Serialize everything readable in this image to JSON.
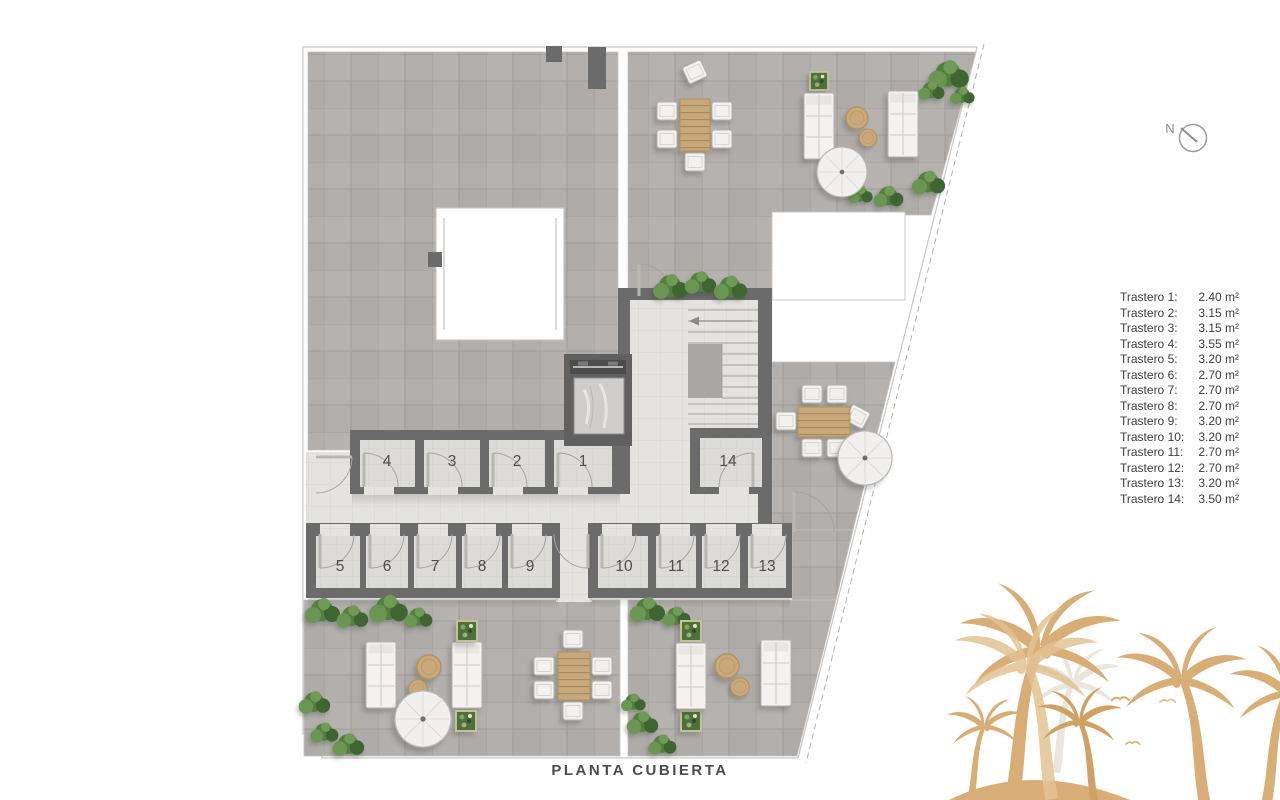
{
  "title": {
    "text": "PLANTA CUBIERTA"
  },
  "compass": {
    "label": "N"
  },
  "legend": {
    "items": [
      {
        "name": "Trastero 1:",
        "area": "2.40 m²"
      },
      {
        "name": "Trastero 2:",
        "area": "3.15 m²"
      },
      {
        "name": "Trastero 3:",
        "area": "3.15 m²"
      },
      {
        "name": "Trastero 4:",
        "area": "3.55 m²"
      },
      {
        "name": "Trastero 5:",
        "area": "3.20 m²"
      },
      {
        "name": "Trastero 6:",
        "area": "2.70 m²"
      },
      {
        "name": "Trastero 7:",
        "area": "2.70 m²"
      },
      {
        "name": "Trastero 8:",
        "area": "2.70 m²"
      },
      {
        "name": "Trastero 9:",
        "area": "3.20 m²"
      },
      {
        "name": "Trastero 10:",
        "area": "3.20 m²"
      },
      {
        "name": "Trastero 11:",
        "area": "2.70 m²"
      },
      {
        "name": "Trastero 12:",
        "area": "2.70 m²"
      },
      {
        "name": "Trastero 13:",
        "area": "3.20 m²"
      },
      {
        "name": "Trastero 14:",
        "area": "3.50 m²"
      }
    ]
  },
  "plan": {
    "rooms": {
      "r1": {
        "number": "1"
      },
      "r2": {
        "number": "2"
      },
      "r3": {
        "number": "3"
      },
      "r4": {
        "number": "4"
      },
      "r5": {
        "number": "5"
      },
      "r6": {
        "number": "6"
      },
      "r7": {
        "number": "7"
      },
      "r8": {
        "number": "8"
      },
      "r9": {
        "number": "9"
      },
      "r10": {
        "number": "10"
      },
      "r11": {
        "number": "11"
      },
      "r12": {
        "number": "12"
      },
      "r13": {
        "number": "13"
      },
      "r14": {
        "number": "14"
      }
    }
  },
  "icons": {
    "compass": "north-compass-icon",
    "watermark": "palm-trees-watermark"
  },
  "colors": {
    "terrace": "#b4b1ae",
    "corridor": "#e4e3e0",
    "wall": "#6b6b6b",
    "wood": "#c7a87a",
    "plant": "#54803f",
    "watermark": "#d9ad76"
  }
}
